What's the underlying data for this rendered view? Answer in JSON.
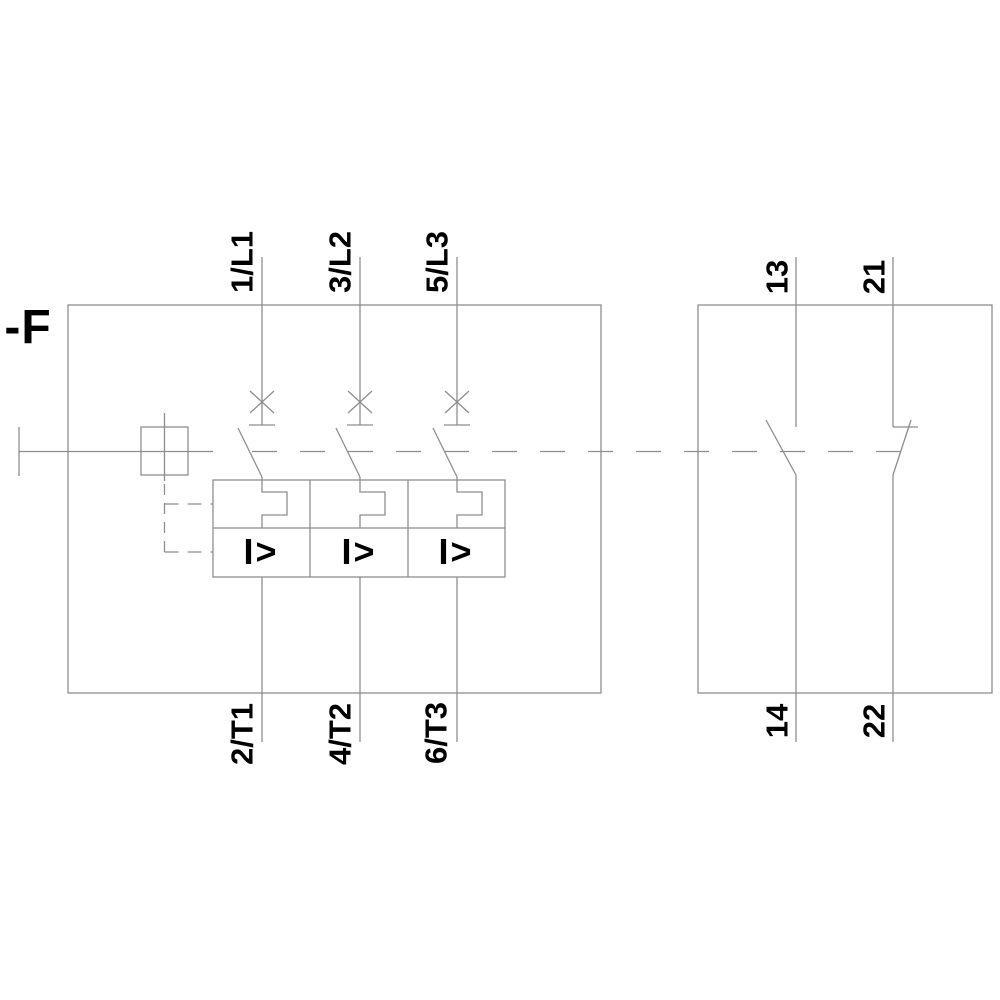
{
  "diagram": {
    "device_label": "-F",
    "main_poles": [
      {
        "top_terminal": "1/L1",
        "bottom_terminal": "2/T1",
        "trip_symbol": "I>"
      },
      {
        "top_terminal": "3/L2",
        "bottom_terminal": "4/T2",
        "trip_symbol": "I>"
      },
      {
        "top_terminal": "5/L3",
        "bottom_terminal": "6/T3",
        "trip_symbol": "I>"
      }
    ],
    "aux_contacts": [
      {
        "type": "NO",
        "top_terminal": "13",
        "bottom_terminal": "14"
      },
      {
        "type": "NC",
        "top_terminal": "21",
        "bottom_terminal": "22"
      }
    ],
    "colors": {
      "line": "#8e8e8e",
      "text": "#000000",
      "background": "#ffffff"
    }
  }
}
